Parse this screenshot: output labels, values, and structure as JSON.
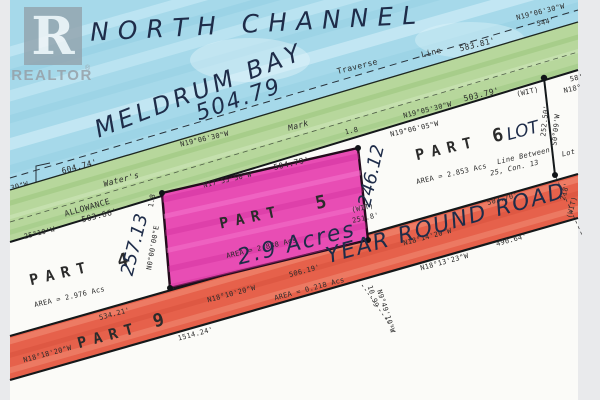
{
  "branding": {
    "logo_letter": "R",
    "logo_name": "REALTOR",
    "reg": "®"
  },
  "handwritten": {
    "channel": "NORTH CHANNEL",
    "bay": "MELDRUM BAY",
    "bay_distance": "504.79",
    "acreage": "2.9 Acres",
    "road_name": "YEAR ROUND ROAD",
    "lot": "LOT",
    "dim_right": "246.12",
    "dim_left": "257.13"
  },
  "water": {
    "traverse_word1": "Traverse",
    "traverse_word2": "Line",
    "traverse_bearing": "N19°06'30\"W",
    "traverse_distance": "583.81'",
    "corner_bearing": "N19°06'30\"W",
    "corner_distance": "544'",
    "left_distance": "604.74'",
    "left_bearing_fragment": "30\"W"
  },
  "shoreline": {
    "waters_word1": "Water's",
    "waters_word2": "Mark",
    "allowance": "ALLOWANCE",
    "bearing": "N19°06'30\"W",
    "below_bearing": "N19°05'30\"W",
    "below_distance": "503.79'",
    "left_below_bearing": "25°10'W",
    "left_below_distance": "503.66'"
  },
  "part4": {
    "name": "PART",
    "number": "4",
    "area": "AREA = 2.976 Acs",
    "east_bearing": "N0°00'00\"E",
    "east_distance": "250.18'"
  },
  "part5": {
    "name": "PART",
    "number": "5",
    "area": "AREA = 2.888 Acs",
    "top_bearing": "N17°55'50\"W",
    "top_distance": "504.79'",
    "wit_label": "(WIT)",
    "wit_distance": "251.8'",
    "wit_tick_a": "1.8",
    "wit_tick_b": "1.8"
  },
  "part6": {
    "name": "PART",
    "number": "6",
    "area": "AREA = 2.853 Acs",
    "line_between_1": "Line Between",
    "line_between_2": "25, Con. 13",
    "top_bearing": "N19°06'05\"W",
    "wit_label": "(WIT)",
    "east_distance": "252.50'",
    "east_bearing": "S0°09'W",
    "lot_fragment": "Lot",
    "edge_fragment_1": "58'",
    "edge_fragment_2": "N18°"
  },
  "road": {
    "part_name": "PART",
    "part_number": "9",
    "seg_left_distance": "534.21'",
    "seg_left_bearing": "N18°18'20\"W",
    "below_left_distance": "1514.24'",
    "seg_mid_bearing": "N18°10'20\"W",
    "seg_mid_distance": "506.19'",
    "seg_mid_area": "AREA = 0.218 Acs",
    "seg_right_bearing": "N18°14'20\"W",
    "seg_right_distance": "502.70'",
    "below_right_distance": "490.64'",
    "below_right_bearing": "N18°13'23\"W",
    "edge_fragment": "218'",
    "edge_wit": "(WIT)"
  },
  "misc": {
    "tie_distance": "10.99",
    "tie_bearing": "N9°49'10\"W"
  },
  "colors": {
    "water": "#a6d9ea",
    "shore": "#b7d79c",
    "parcel": "#e84db4",
    "road": "#e6614b"
  }
}
